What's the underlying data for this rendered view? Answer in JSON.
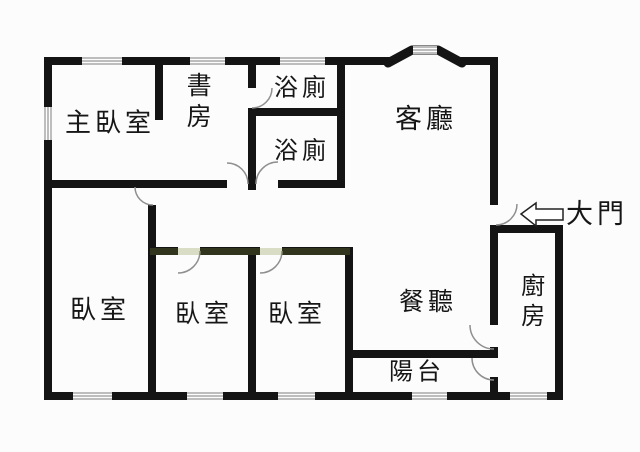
{
  "plan": {
    "type": "apartment-floor-plan",
    "background": "#fcfcfc",
    "wall_color": "#141414",
    "door_arc_color": "#8f8f8f",
    "window_line_color": "#7e7e7e",
    "label_color": "#161616",
    "watermark_tint": "#7c8c3a"
  },
  "rooms": [
    {
      "id": "master-bedroom",
      "label": "主臥室"
    },
    {
      "id": "study",
      "label": "書房"
    },
    {
      "id": "bathroom-upper",
      "label": "浴廁"
    },
    {
      "id": "bathroom-lower",
      "label": "浴廁"
    },
    {
      "id": "living-room",
      "label": "客廳"
    },
    {
      "id": "bedroom-left",
      "label": "臥室"
    },
    {
      "id": "bedroom-middle",
      "label": "臥室"
    },
    {
      "id": "bedroom-right",
      "label": "臥室"
    },
    {
      "id": "dining-room",
      "label": "餐聽"
    },
    {
      "id": "balcony",
      "label": "陽台"
    },
    {
      "id": "kitchen",
      "label": "廚房"
    }
  ],
  "entrance": {
    "label": "大門",
    "arrow_direction": "left"
  }
}
